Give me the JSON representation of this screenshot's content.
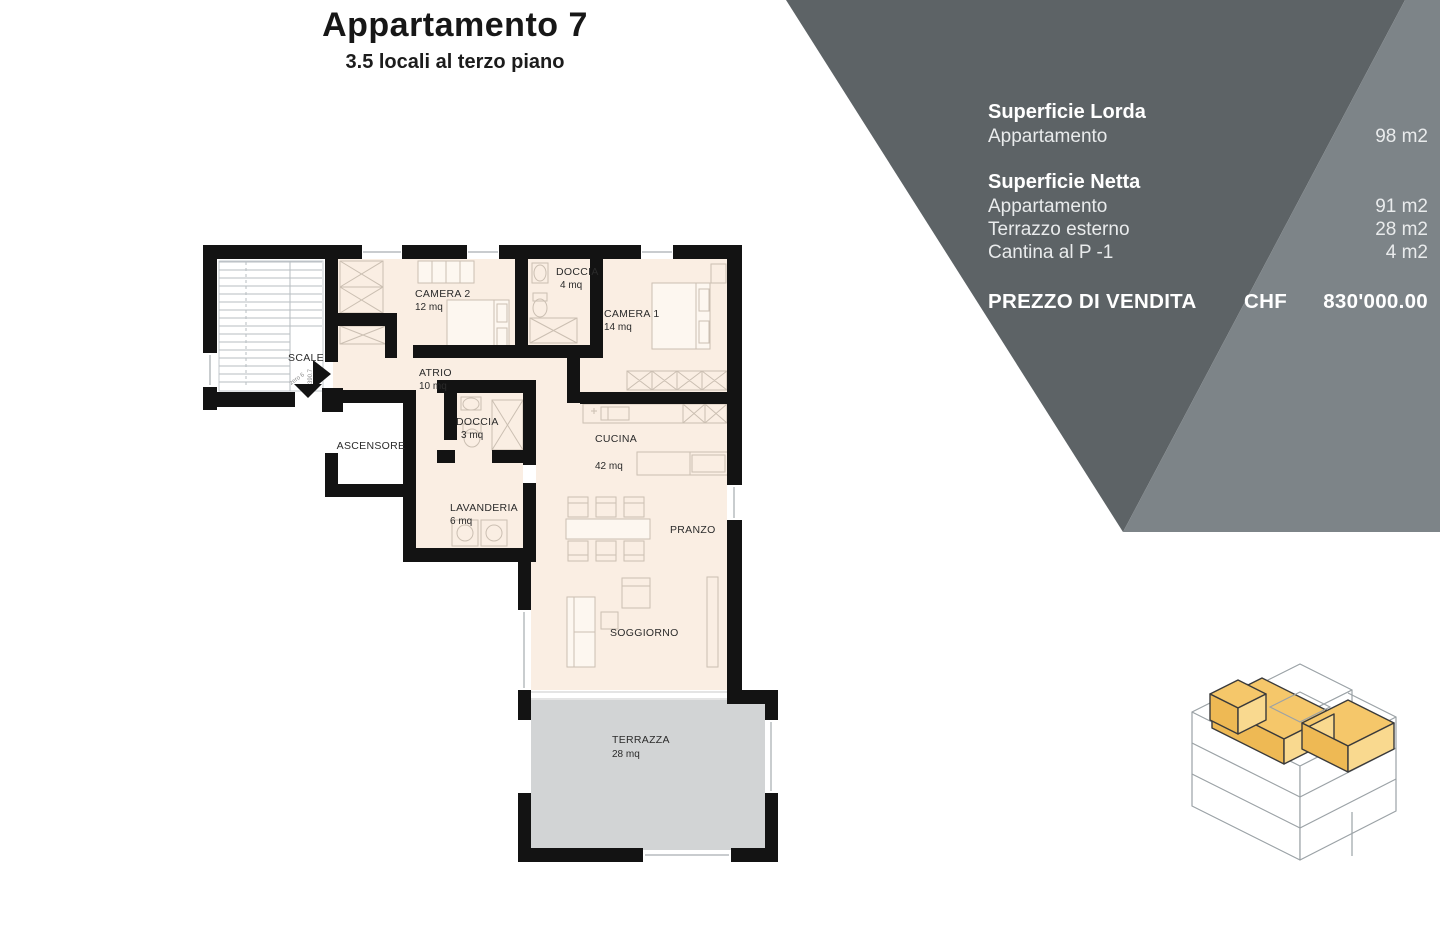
{
  "title": "Appartamento 7",
  "subtitle": "3.5 locali al terzo piano",
  "info_panel": {
    "sections": [
      {
        "header": "Superficie Lorda",
        "rows": [
          {
            "label": "Appartamento",
            "value": "98 m2"
          }
        ]
      },
      {
        "header": "Superficie Netta",
        "rows": [
          {
            "label": "Appartamento",
            "value": "91 m2"
          },
          {
            "label": "Terrazzo esterno",
            "value": "28 m2"
          },
          {
            "label": "Cantina al P -1",
            "value": "4 m2"
          }
        ]
      }
    ],
    "price": {
      "label": "PREZZO DI VENDITA",
      "currency": "CHF",
      "amount": "830'000.00"
    },
    "colors": {
      "dark_panel": "#5d6366",
      "light_panel": "#7d8488"
    }
  },
  "floor_plan": {
    "rooms": [
      {
        "name": "SCALE",
        "area": ""
      },
      {
        "name": "ASCENSORE",
        "area": ""
      },
      {
        "name": "CAMERA 2",
        "area": "12 mq"
      },
      {
        "name": "DOCCIA",
        "area": "4 mq"
      },
      {
        "name": "CAMERA 1",
        "area": "14 mq"
      },
      {
        "name": "ATRIO",
        "area": "10 mq"
      },
      {
        "name": "DOCCIA",
        "area": "3 mq"
      },
      {
        "name": "CUCINA",
        "area": "42 mq"
      },
      {
        "name": "LAVANDERIA",
        "area": "6 mq"
      },
      {
        "name": "PRANZO",
        "area": ""
      },
      {
        "name": "SOGGIORNO",
        "area": ""
      },
      {
        "name": "TERRAZZA",
        "area": "28 mq"
      }
    ],
    "annotations": {
      "quota_1": "390.7",
      "quota_2": "zero 6"
    },
    "colors": {
      "floor": "#faeee3",
      "terrace": "#d2d4d5",
      "wall": "#131313"
    }
  },
  "building_icon": {
    "highlight_color": "#f5c76a"
  }
}
